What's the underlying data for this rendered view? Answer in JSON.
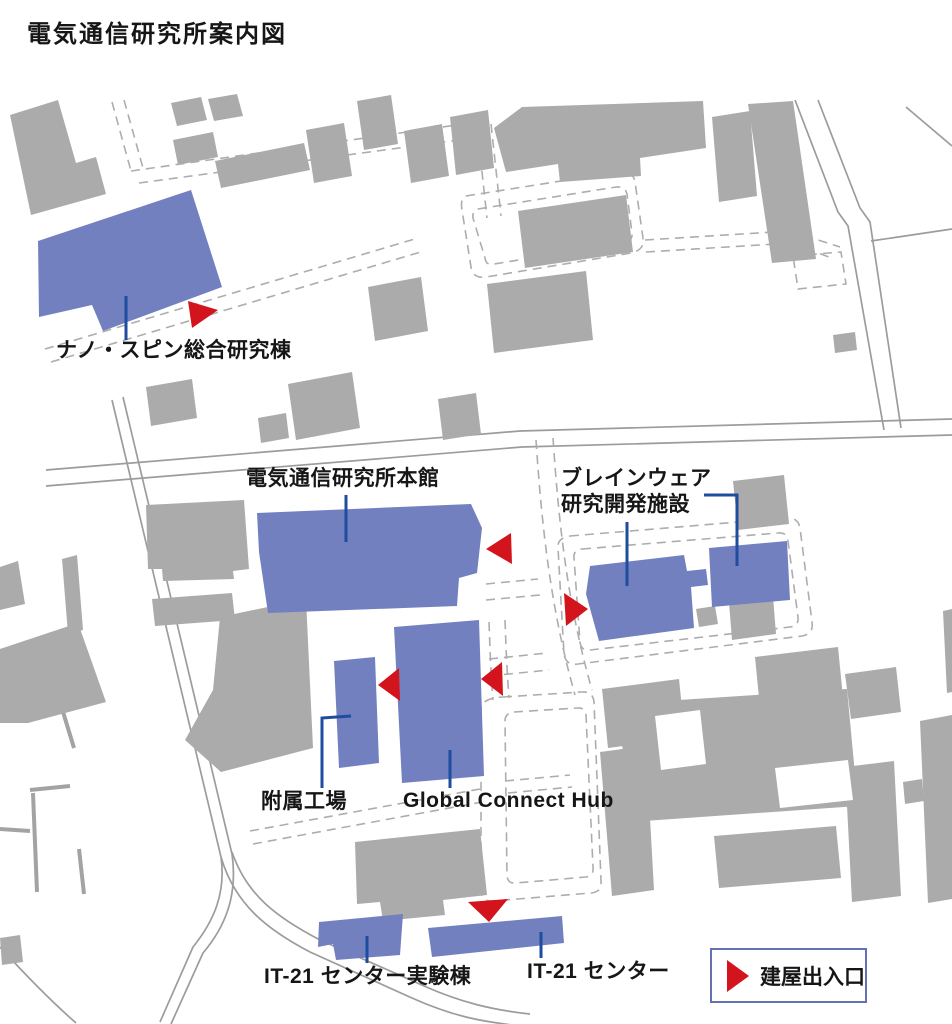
{
  "title": "電気通信研究所案内図",
  "legend": {
    "label": "建屋出入口"
  },
  "colors": {
    "building_highlight": "#7280C0",
    "building_other": "#ABABAB",
    "entrance": "#D4141C",
    "leader": "#1E4C9F",
    "road": "#9C9C9C",
    "path": "#ADADAD",
    "fence": "#A3A3A3",
    "legend_border": "#6471B6",
    "text": "#161616"
  },
  "map": {
    "labeled_buildings": [
      {
        "id": "nano-spin",
        "label": "ナノ・スピン総合研究棟",
        "polygon": "38,241 191,190 222,287 103,331 92,305 39,317",
        "leader": "M126,296 L126,340"
      },
      {
        "id": "honkan",
        "label": "電気通信研究所本館",
        "polygon": "257,513 471,504 482,528 477,573 459,578 457,606 268,613 259,552",
        "leader": "M346,495 L346,542"
      },
      {
        "id": "brainware",
        "label_lines": [
          "ブレインウェア",
          "研究開発施設"
        ],
        "polygon": "590,566 684,555 687,571 706,569 708,585 691,587 694,628 599,641 586,594",
        "polygon2": "709,548 787,541 790,600 712,607",
        "leader": "M627,522 L627,586",
        "leader2": "M704,495 L737,495 L737,566"
      },
      {
        "id": "fuzoku-kojo",
        "label": "附属工場",
        "polygon": "334,661 375,657 379,763 339,768",
        "leader": "M351,716 L322,718 L322,788"
      },
      {
        "id": "global-connect-hub",
        "label": "Global Connect Hub",
        "polygon": "394,627 479,620 484,776 402,783",
        "leader": "M450,750 L450,788"
      },
      {
        "id": "it21-center-lab",
        "label": "IT-21 センター実験棟",
        "polygon": "319,922 403,914 400,955 336,960 333,944 318,947",
        "leader": "M367,936 L367,963"
      },
      {
        "id": "it21-center",
        "label": "IT-21 センター",
        "polygon": "428,928 562,916 564,943 432,957",
        "leader": "M541,932 L541,958"
      }
    ],
    "entrances": [
      "188,301 218,310 192,328",
      "511,533 486,549 512,564",
      "564,593 588,609 566,626",
      "399,668 378,685 400,701",
      "502,662 481,679 503,696",
      "468,902 508,899 489,922"
    ],
    "roads": [
      "M46,470 L520,431 L952,419",
      "M46,486 L522,447 L952,435",
      "M112,400 L221,857 C226,893 214,921 193,947 L160,1022",
      "M123,397 L232,854 C238,896 225,927 203,953 L171,1024",
      "M221,857 C235,905 268,930 310,952 L412,998 C452,1016 482,1022 522,1026",
      "M232,852 C247,896 278,918 320,940 L424,986 C460,1002 492,1010 530,1014",
      "M795,100 L838,212 L848,226 L884,430",
      "M818,100 L860,208 L870,222 L901,428",
      "M871,241 L952,229",
      "M906,107 L952,146",
      "M0,947 C30,980 52,1002 76,1023"
    ],
    "fences": [
      "M60,702 L74,748",
      "M30,790 L70,786",
      "M33,793 L37,892",
      "M79,849 L84,894",
      "M0,829 L30,831"
    ],
    "dashed_paths": [
      "M45,349 L418,238",
      "M51,362 L424,251",
      "M112,102 L131,171",
      "M124,100 L143,168",
      "M131,171 L478,122",
      "M139,183 L481,137",
      "M477,126 L487,218",
      "M491,124 L501,216",
      "M466,196 L618,172 Q633,170 635,182 L643,238 Q645,250 631,253 L486,277 Q473,279 471,267 L462,210 Q460,198 466,196 Z",
      "M478,209 L616,187 Q625,186 627,194 L632,233 Q633,241 624,243 L494,264 Q486,266 485,258 L473,218 Q472,211 478,209 Z",
      "M645,240 L790,231",
      "M646,252 L792,243",
      "M790,231 L840,247",
      "M792,243 L834,259",
      "M793,256 L841,252 L846,284 L798,289 Z",
      "M536,440 C542,530 551,610 575,695",
      "M553,438 C559,528 568,606 592,690",
      "M486,584 L538,579",
      "M486,600 L540,595",
      "M489,659 L547,653",
      "M489,676 L549,670",
      "M570,536 L786,518 Q798,517 800,528 L812,622 Q814,634 802,636 L578,664 Q566,666 564,654 L558,548 Q557,538 570,536 Z",
      "M582,549 L778,533 Q787,532 788,541 L798,617 Q799,626 790,627 L590,650 Q581,651 580,642 L574,558 Q573,550 582,549 Z",
      "M503,697 L581,692 Q593,691 594,702 L601,881 Q602,892 591,893 L493,901 Q482,902 481,891 L481,710 Q481,698 503,697 Z",
      "M514,712 L577,708 Q585,707 586,715 L593,867 Q594,876 586,877 L516,883 Q508,884 507,876 L505,721 Q505,713 514,712 Z",
      "M489,622 C490,650 491,675 493,700",
      "M505,620 C506,648 507,672 509,698",
      "M505,781 L570,775",
      "M508,793 L572,787",
      "M250,831 L480,789",
      "M253,844 L482,802"
    ],
    "background_buildings": [
      "10,115 58,100 76,163 96,157 106,194 31,215",
      "171,103 201,97 207,120 177,126",
      "208,99 237,94 243,116 214,121",
      "173,140 213,132 218,157 178,165",
      "215,161 304,143 310,170 221,188",
      "306,130 344,123 352,176 314,183",
      "357,101 391,95 398,144 364,150",
      "404,131 442,124 449,176 411,183",
      "450,117 488,110 494,168 456,175",
      "494,128 522,107 703,101 706,148 640,158 641,176 560,182 558,164 506,172",
      "712,117 750,111 757,196 719,202",
      "748,104 793,101 816,259 772,263",
      "833,335 855,332 857,350 835,353",
      "368,287 421,277 428,331 375,341",
      "288,384 352,372 360,428 296,440",
      "146,387 192,379 197,418 151,426",
      "438,399 476,393 481,434 443,440",
      "487,284 586,271 593,340 494,353",
      "518,211 626,195 633,252 525,268",
      "146,505 244,500 249,569 233,571 234,579 163,581 162,569 148,569",
      "152,599 232,593 235,620 155,626",
      "0,567 18,561 25,604 0,610",
      "62,559 77,555 83,630 68,634",
      "0,649 78,623 106,702 28,723 0,723",
      "220,617 306,599 313,748 221,772 185,740 213,690",
      "355,842 480,829 487,895 443,900 445,915 383,921 380,902 357,904",
      "610,751 649,745 655,798 616,804",
      "602,689 679,679 685,738 608,748",
      "728,590 772,584 776,634 732,640",
      "696,609 715,606 718,624 699,627",
      "733,481 784,475 789,524 738,530",
      "755,657 838,647 844,708 761,718",
      "845,674 896,667 901,712 851,719",
      "618,704 847,689 858,806 630,822",
      "714,836 836,826 841,878 719,888",
      "845,767 894,761 901,896 852,902",
      "920,721 952,715 952,899 928,903",
      "903,782 922,779 924,801 905,804",
      "943,611 952,609 952,692 947,693",
      "258,418 286,413 289,438 261,443",
      "600,752 646,746 654,890 612,896",
      "0,938 20,935 23,962 2,965"
    ],
    "courtyards": [
      "655,716 700,710 706,764 661,770",
      "775,768 848,760 853,800 780,808"
    ]
  }
}
